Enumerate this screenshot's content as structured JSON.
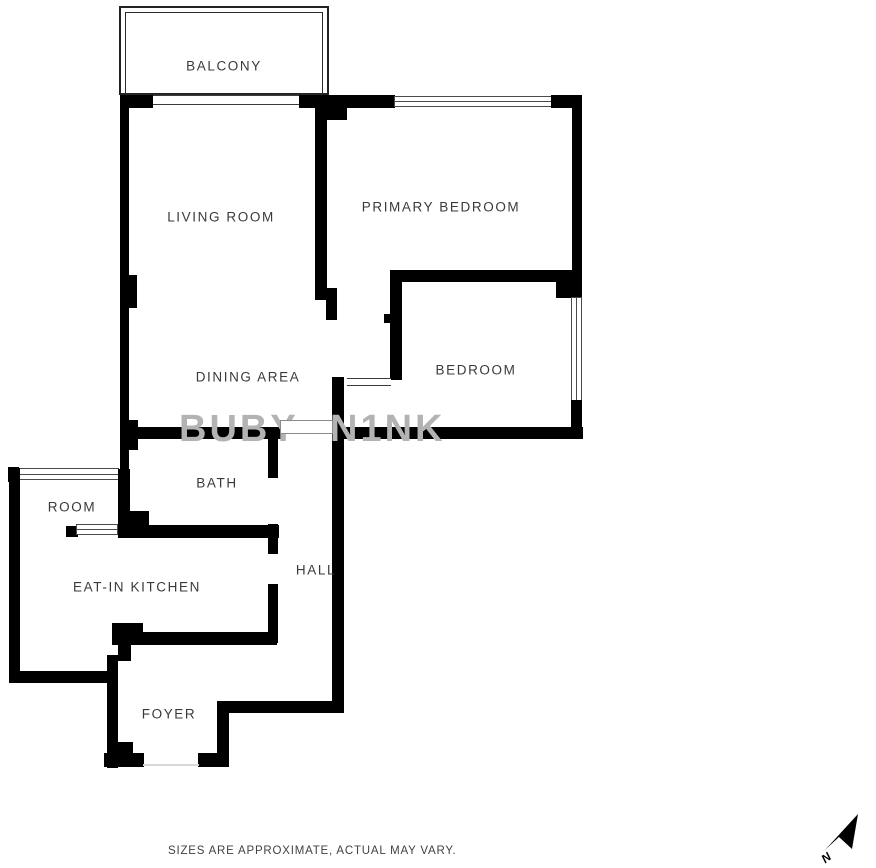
{
  "rooms": {
    "balcony": "BALCONY",
    "living_room": "LIVING ROOM",
    "primary_bedroom": "PRIMARY BEDROOM",
    "bedroom": "BEDROOM",
    "dining_area": "DINING AREA",
    "bath": "BATH",
    "room": "ROOM",
    "eat_in_kitchen": "EAT-IN KITCHEN",
    "hall": "HALL",
    "foyer": "FOYER"
  },
  "watermark": {
    "fragment_left": "BUBY",
    "fragment_right": "N1NK"
  },
  "footer": {
    "disclaimer": "SIZES ARE APPROXIMATE, ACTUAL MAY VARY."
  },
  "compass": {
    "north_label": "N"
  },
  "colors": {
    "wall": "#000000",
    "background": "#ffffff",
    "label_text": "#3a3a3a",
    "watermark_gray": "#b3b3b3"
  }
}
